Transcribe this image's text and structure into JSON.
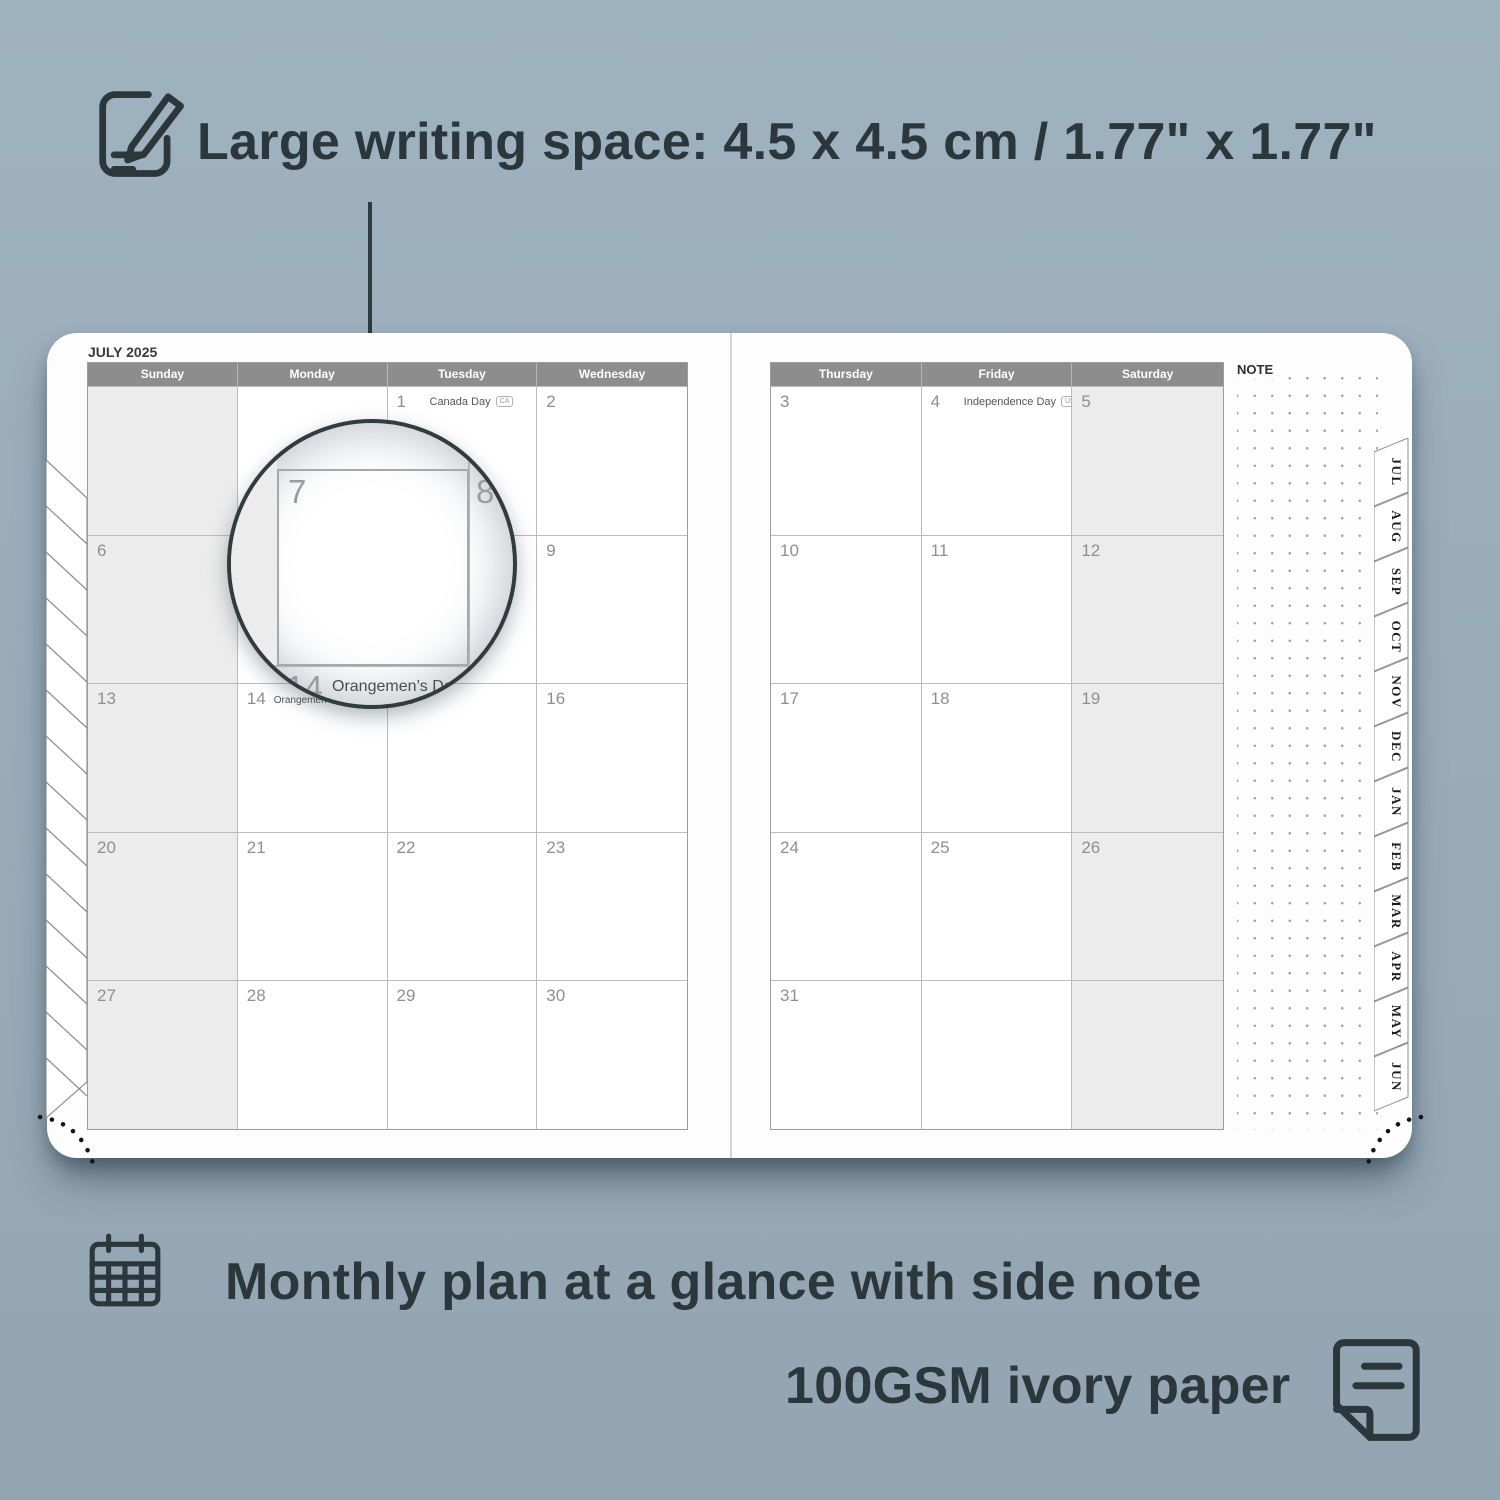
{
  "top_note": {
    "icon": "note-pencil-icon",
    "text": "Large writing space: 4.5 x 4.5 cm / 1.77\" x 1.77\""
  },
  "bottom_notes": [
    {
      "icon": "calendar-grid-icon",
      "text": "Monthly plan at a glance with side note"
    },
    {
      "icon": "paper-sheet-icon",
      "text": "100GSM ivory paper"
    }
  ],
  "calendar": {
    "title": "JULY 2025",
    "note_label": "NOTE",
    "left_day_headers": [
      "Sunday",
      "Monday",
      "Tuesday",
      "Wednesday"
    ],
    "right_day_headers": [
      "Thursday",
      "Friday",
      "Saturday"
    ],
    "left_rows": [
      [
        {
          "day": ""
        },
        {
          "day": ""
        },
        {
          "day": "1",
          "holiday": "Canada Day",
          "badge": "CA"
        },
        {
          "day": "2"
        }
      ],
      [
        {
          "day": "6"
        },
        {
          "day": "7"
        },
        {
          "day": "8"
        },
        {
          "day": "9"
        }
      ],
      [
        {
          "day": "13"
        },
        {
          "day": "14",
          "holiday": "Orangemen’s Day (n.i.)",
          "badge": "UK",
          "small": true
        },
        {
          "day": "15"
        },
        {
          "day": "16"
        }
      ],
      [
        {
          "day": "20"
        },
        {
          "day": "21"
        },
        {
          "day": "22"
        },
        {
          "day": "23"
        }
      ],
      [
        {
          "day": "27"
        },
        {
          "day": "28"
        },
        {
          "day": "29"
        },
        {
          "day": "30"
        }
      ]
    ],
    "right_rows": [
      [
        {
          "day": "3"
        },
        {
          "day": "4",
          "holiday": "Independence Day",
          "badge": "US"
        },
        {
          "day": "5"
        }
      ],
      [
        {
          "day": "10"
        },
        {
          "day": "11"
        },
        {
          "day": "12"
        }
      ],
      [
        {
          "day": "17"
        },
        {
          "day": "18"
        },
        {
          "day": "19"
        }
      ],
      [
        {
          "day": "24"
        },
        {
          "day": "25"
        },
        {
          "day": "26"
        }
      ],
      [
        {
          "day": "31"
        },
        {
          "day": ""
        },
        {
          "day": ""
        }
      ]
    ],
    "month_tabs": [
      "JUL",
      "AUG",
      "SEP",
      "OCT",
      "NOV",
      "DEC",
      "JAN",
      "FEB",
      "MAR",
      "APR",
      "MAY",
      "JUN"
    ]
  },
  "magnifier": {
    "day_left": "7",
    "day_right": "8",
    "below_day": "14",
    "below_holiday": "Orangemen’s Day (n.i.)",
    "below_badge": "UK"
  },
  "colors": {
    "background": "#99abb8",
    "ink": "#2c373c",
    "header_bar": "#8d8d8d",
    "weekend_cell": "#ececec",
    "grid_line": "#bcbcbc",
    "date_number": "#8f8f8f"
  }
}
